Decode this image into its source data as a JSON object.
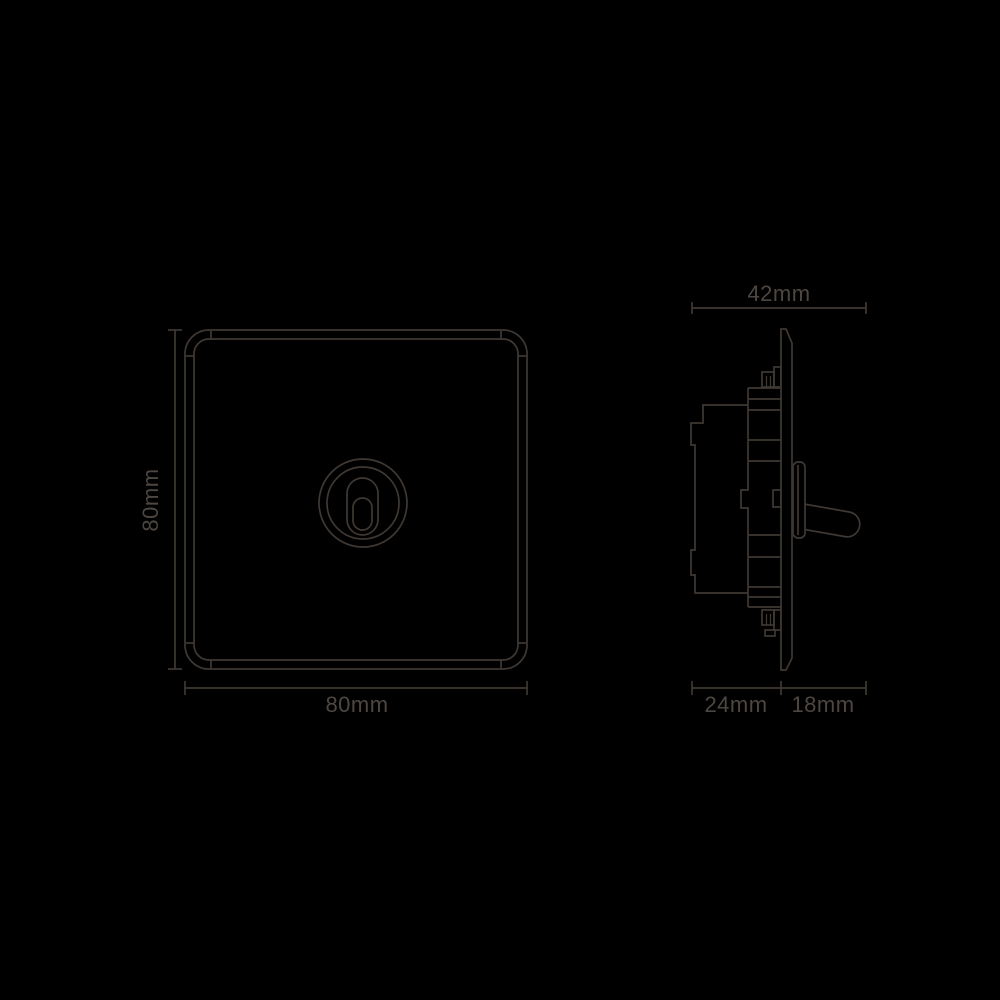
{
  "canvas": {
    "width": 1000,
    "height": 1000,
    "background": "#000000"
  },
  "colors": {
    "line": "#3f3833",
    "text": "#4e4741",
    "bg": "#000000"
  },
  "dimension_labels": {
    "front_height": "80mm",
    "front_width": "80mm",
    "side_total": "42mm",
    "side_depth": "24mm",
    "side_protrusion": "18mm"
  }
}
